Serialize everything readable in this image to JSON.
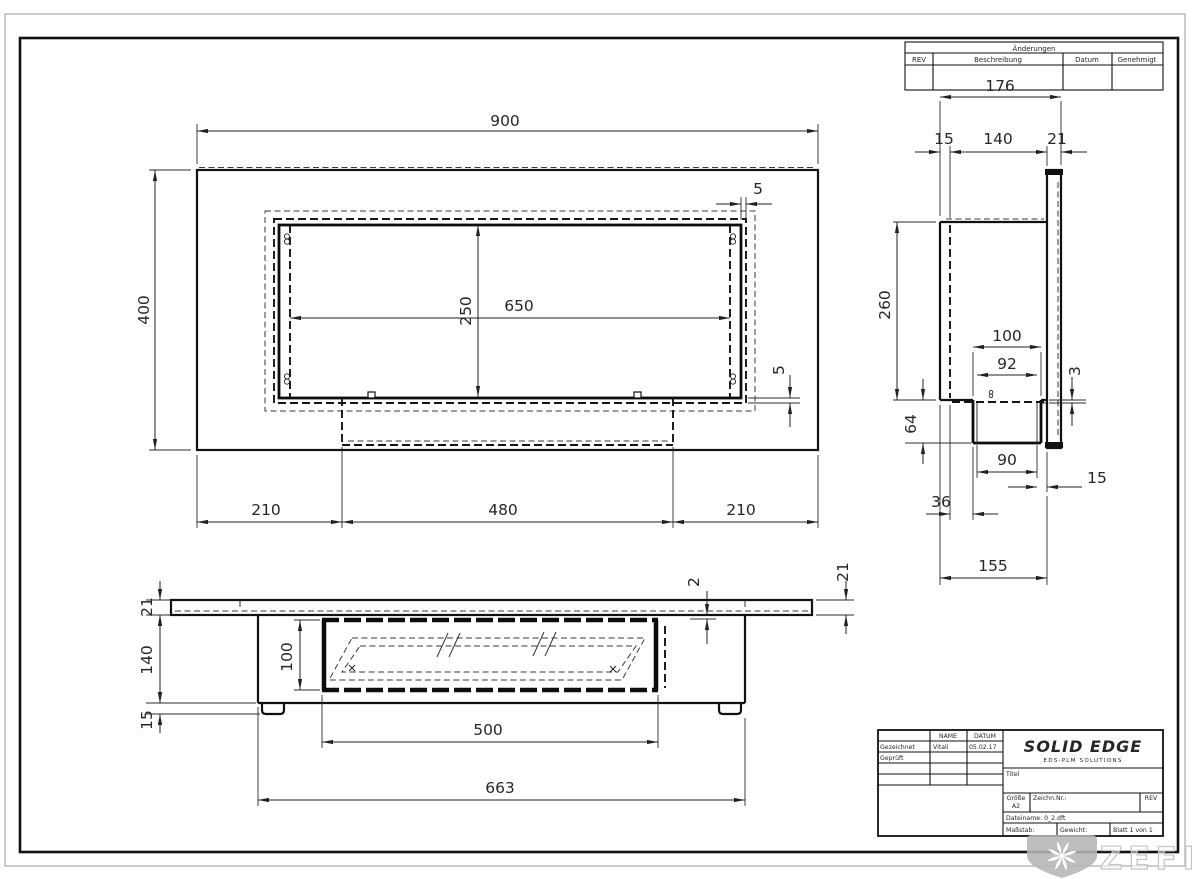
{
  "changes_table": {
    "title": "Änderungen",
    "col_rev": "REV",
    "col_desc": "Beschreibung",
    "col_date": "Datum",
    "col_approved": "Genehmigt"
  },
  "title_block": {
    "name_header": "NAME",
    "date_header": "DATUM",
    "drawn_label": "Gezeichnet",
    "drawn_name": "Vitali",
    "drawn_date": "05.02.17",
    "checked_label": "Geprüft",
    "logo_title": "SOLID EDGE",
    "logo_subtitle": "EDS-PLM SOLUTIONS",
    "doc_title_label": "Titel",
    "size_label": "Größe",
    "size_value": "A2",
    "drawing_number_label": "Zeichn.Nr.:",
    "rev_label": "REV",
    "filename_label": "Dateiname: 0_2.dft",
    "scale_label": "Maßstab:",
    "weight_label": "Gewicht:",
    "sheet_label": "Blatt 1 von 1"
  },
  "watermark": {
    "brand": "ZEFIRE"
  },
  "front_view": {
    "width": "900",
    "height": "400",
    "opening_width": "650",
    "opening_height": "250",
    "lip_top": "5",
    "lip_bottom": "5",
    "left_offset": "210",
    "burner_width": "480",
    "right_offset": "210"
  },
  "side_view": {
    "total_depth": "176",
    "lip": "15",
    "body_depth": "140",
    "panel_thickness": "21",
    "body_height": "260",
    "burner_outer": "100",
    "burner_inner": "92",
    "glass_gap": "3",
    "burner_height": "64",
    "burner_bottom": "90",
    "panel_gap": "15",
    "burner_offset": "36",
    "base_depth": "155"
  },
  "bottom_view": {
    "panel_thickness_left": "21",
    "body_height": "140",
    "feet_height": "15",
    "opening_height": "100",
    "glass_thickness": "2",
    "panel_thickness_right": "21",
    "opening_width": "500",
    "body_width": "663"
  }
}
